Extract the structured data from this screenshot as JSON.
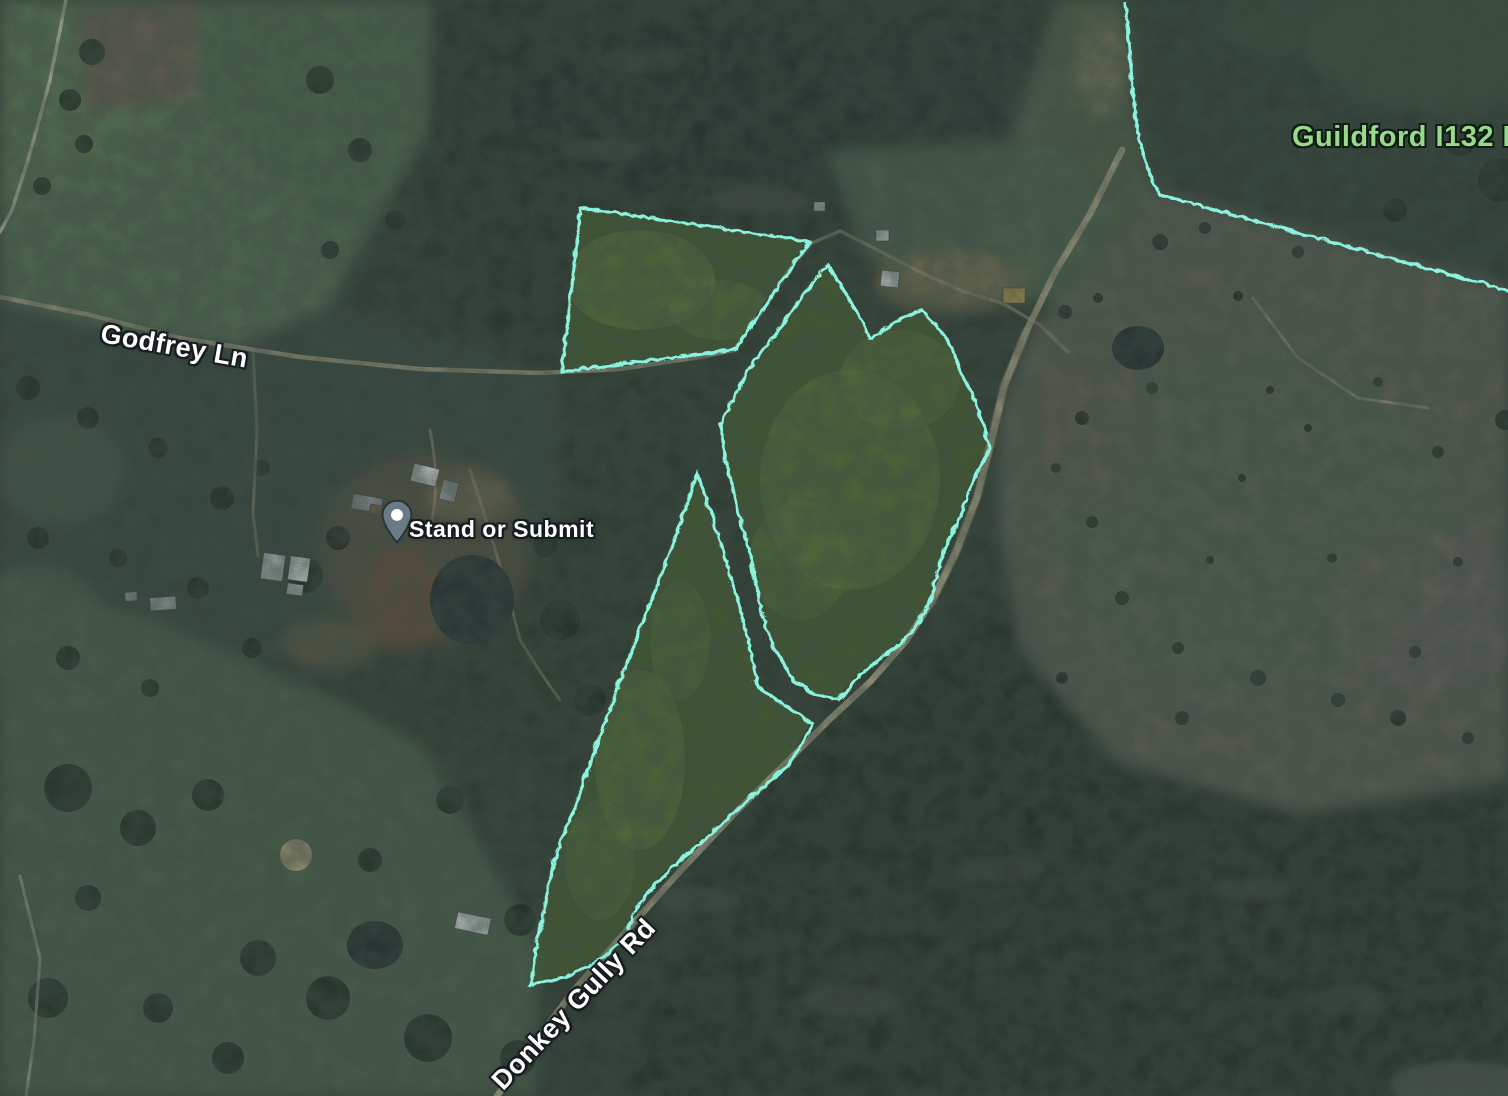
{
  "map": {
    "road_labels": [
      {
        "text": "Godfrey Ln"
      },
      {
        "text": "Donkey Gully Rd"
      }
    ],
    "area_labels": [
      {
        "text": "Guildford I132 B"
      }
    ],
    "placemark": {
      "label": "Stand or Submit"
    },
    "icons": [
      {
        "name": "map-pin-icon",
        "meaning": "placemark location"
      }
    ],
    "colors": {
      "parcel_boundary": "#8bf2de",
      "area_label_text": "#98d98c",
      "road_label_text": "#ffffff",
      "placemark_pin": "#6b7b85"
    }
  }
}
